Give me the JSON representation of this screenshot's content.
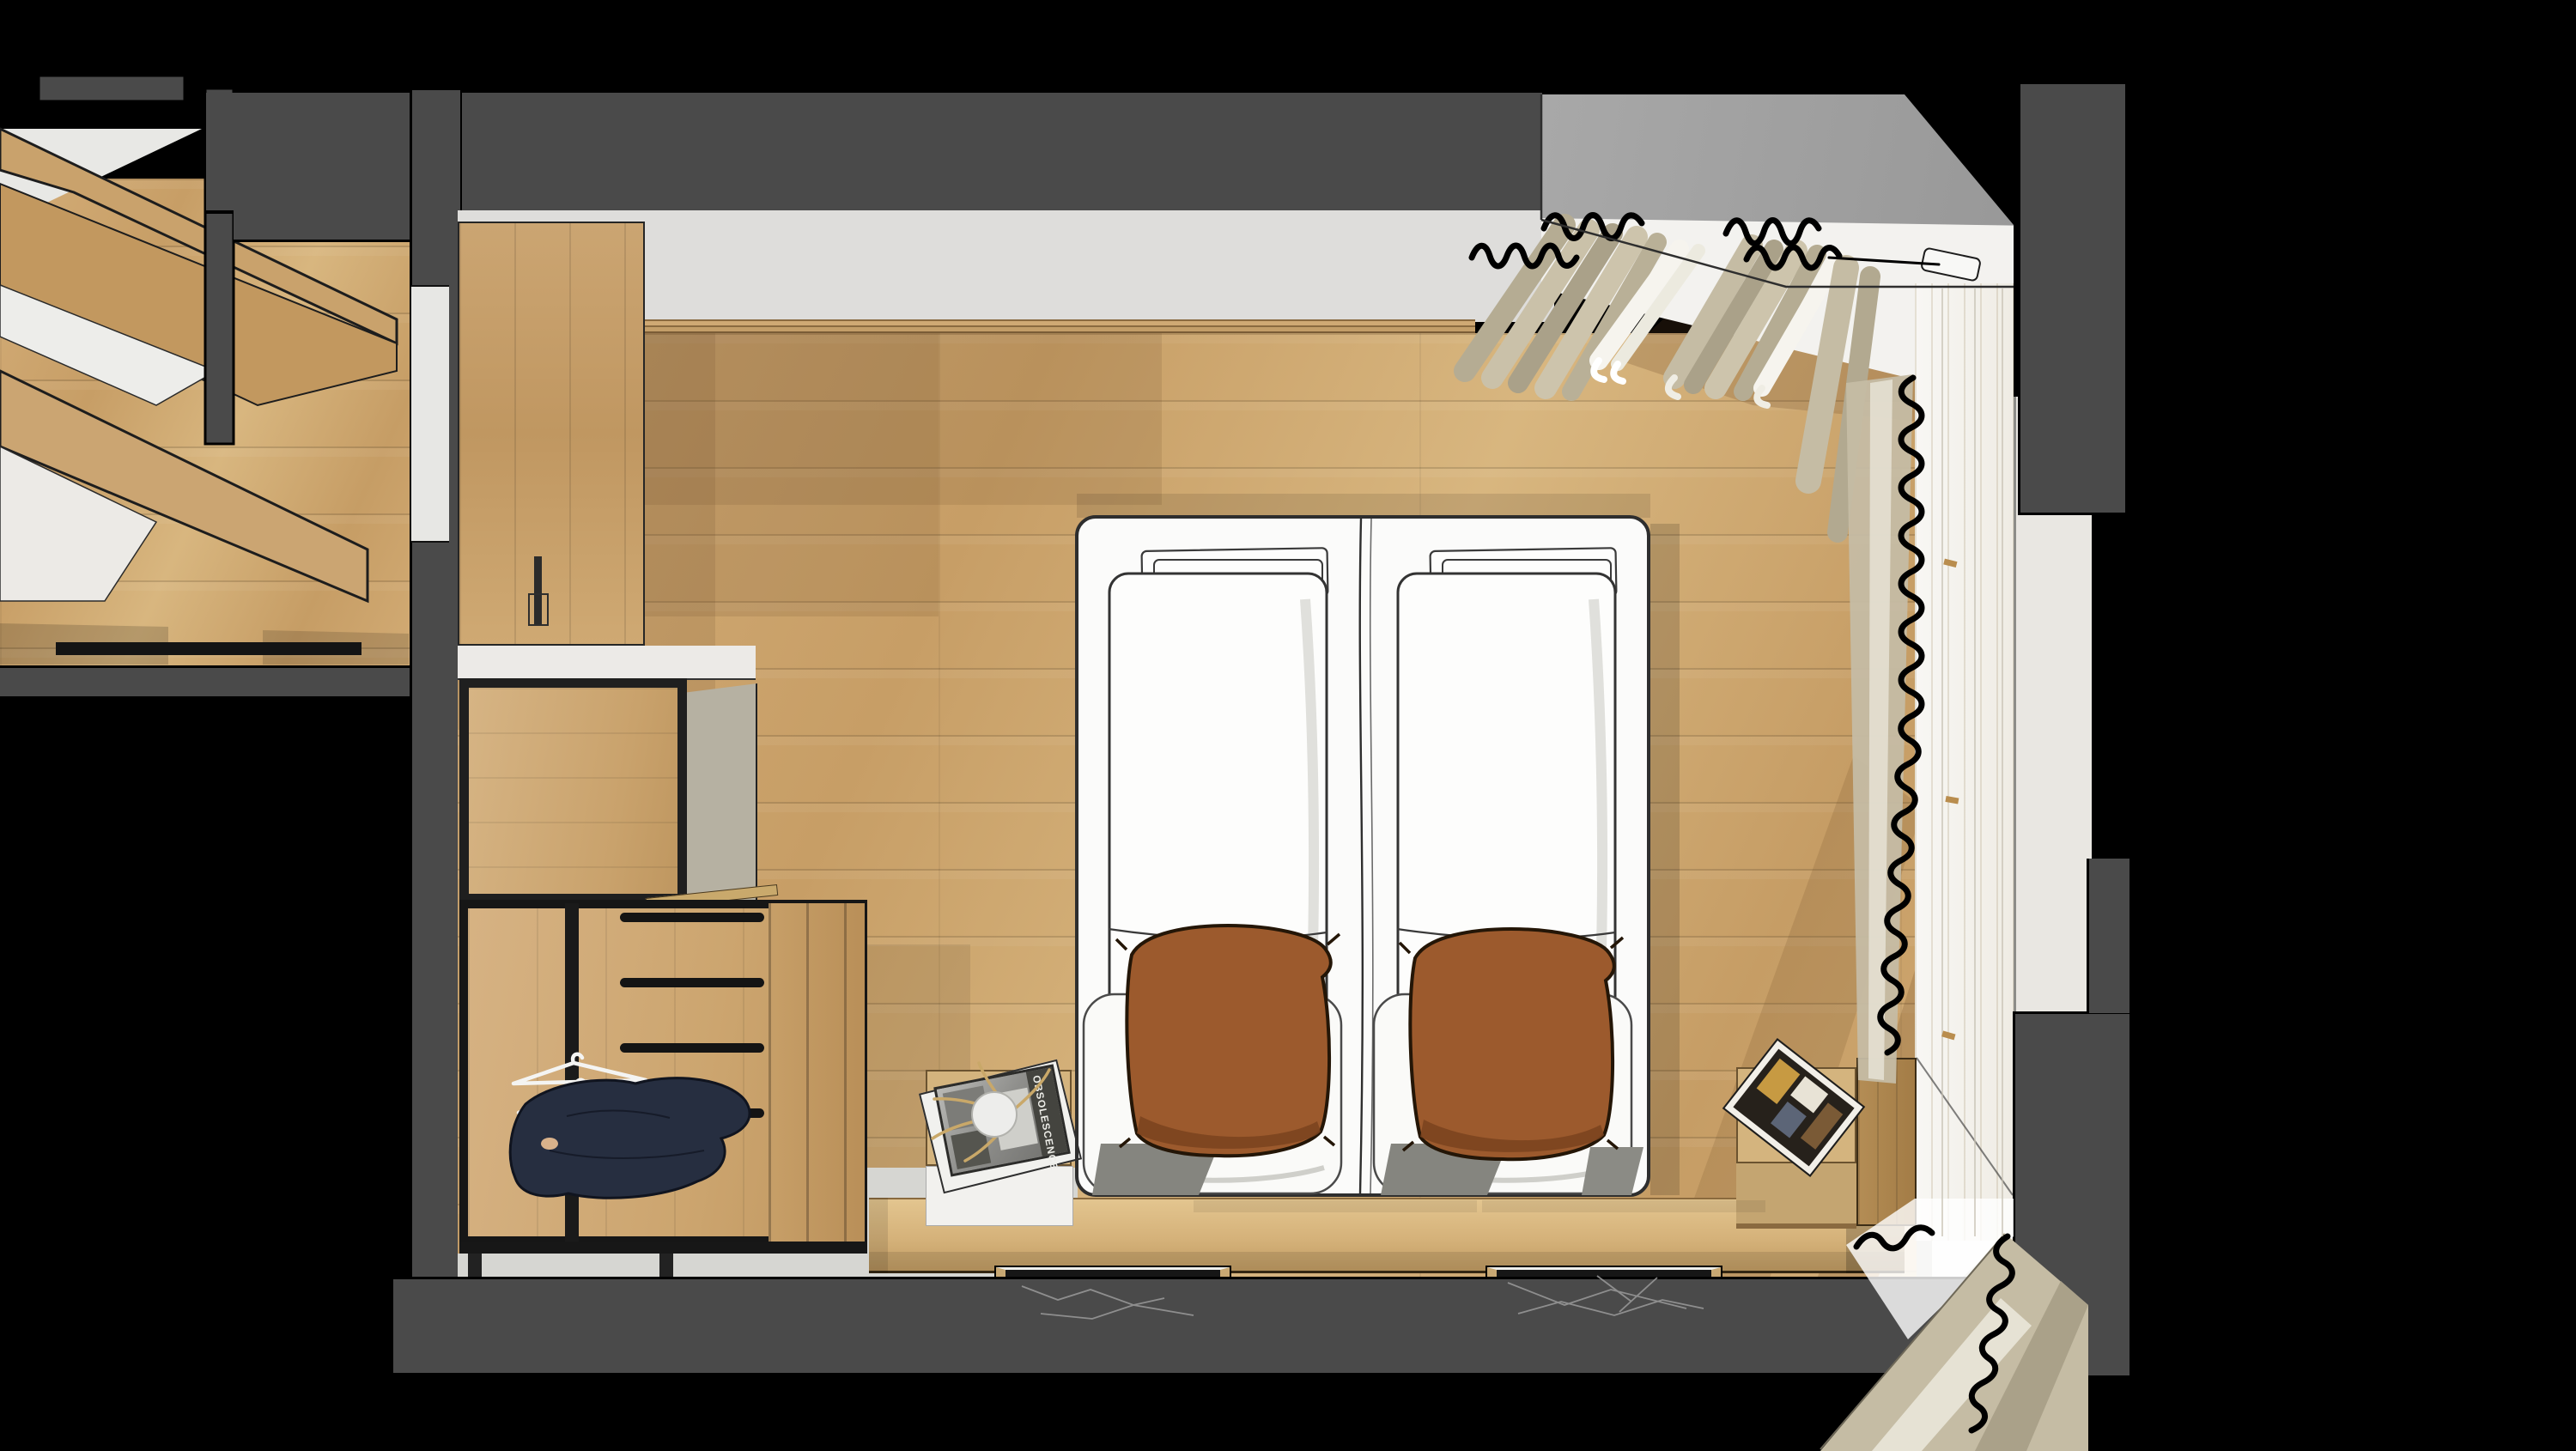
{
  "meta": {
    "scene": "top-down 3d render of a twin-bed hotel bedroom with wardrobe, window and curtains"
  },
  "palette": {
    "bg": "#000000",
    "cutWall": "#4a4a4a",
    "ceiling": "#a0a0a0",
    "upperWall": "#dedddb",
    "woodFloor": "#cda671",
    "wardrobeWood": "#d0ab78",
    "cabinetSide": "#b6b1a2",
    "bench": "#d8b983",
    "bedWhite": "#fbfbfa",
    "sketchInk": "#2e2e2e",
    "pillowRust": "#9c5a2d",
    "pillowRustDark": "#7a431e",
    "curtainBeige": "#c5bca4",
    "curtainBeigeDark": "#aaa189",
    "curtainSheer": "#f4f2ea",
    "navyClothes": "#262e40",
    "marbleBlack": "#161616",
    "marbleVein": "#9a9a9a",
    "grayFloor": "#d6d6d2",
    "sunlight": "#ffffff"
  },
  "objects": {
    "beds": {
      "count": 2,
      "duvets": "folded white duvets",
      "accent_pillows": 2
    },
    "wardrobe": {
      "shelves": 4,
      "hangers": 3,
      "clothes": "navy garments"
    },
    "nightstand_left": {
      "magazine_title": "OBSOLESCENCE",
      "decor": "pampas grass and white dish"
    },
    "nightstand_right": {
      "magazine_cover": "framed interior photo"
    },
    "window": {
      "position": "right wall",
      "curtains": "beige drapes with sheers"
    },
    "mats": {
      "count": 2,
      "material": "black marble"
    }
  }
}
